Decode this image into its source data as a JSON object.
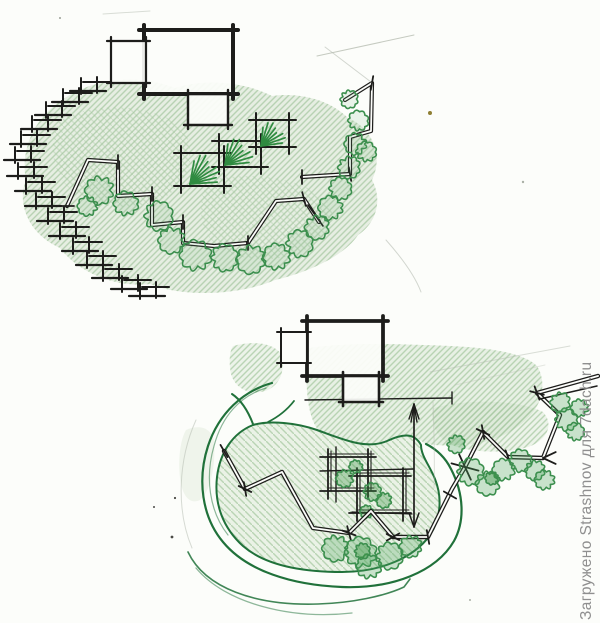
{
  "page": {
    "background": "#fcfdfa"
  },
  "watermark": {
    "text": "Загружено Strashnov для 7dach.ru",
    "color": "#8f8f8f"
  },
  "palette": {
    "ink": "#1d1d1b",
    "paper": "#fcfdfa",
    "shade-green": "#cfe0c9",
    "hatch-green": "#a3c69c",
    "shrub-green": "#3c8f4e",
    "outline-green": "#20713a",
    "plant-green": "#2f8b40",
    "pencil-gray": "#b6bdb2",
    "watermark-gray": "#8f8f8f"
  }
}
